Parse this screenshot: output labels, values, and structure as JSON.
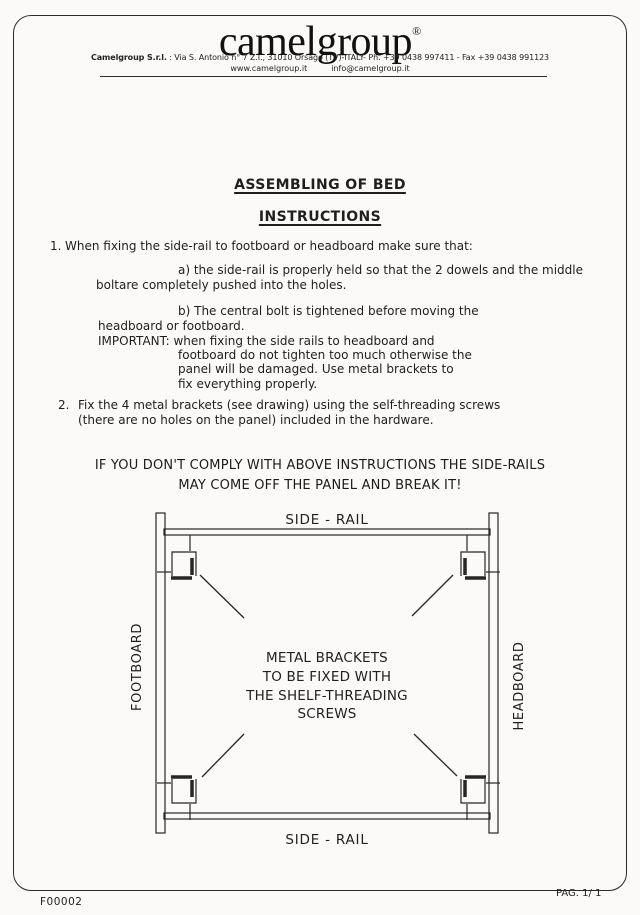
{
  "header": {
    "logo": "camelgroup",
    "registered_mark": "®",
    "company_name": "Camelgroup S.r.l.",
    "address": ": Via S. Antonio n° 7 Z.I., 31010 Orsago (TV)-ITALY- Ph. +39 0438 997411 - Fax +39 0438 991123",
    "website": "www.camelgroup.it",
    "email": "info@camelgroup.it"
  },
  "titles": {
    "main": "ASSEMBLING OF BED",
    "sub": "INSTRUCTIONS"
  },
  "instructions": {
    "item1": {
      "number": "1.",
      "text": "When fixing the side-rail to footboard or headboard make sure that:"
    },
    "item1a": [
      "a) the side-rail is properly held so that the 2 dowels and the middle",
      "boltare completely pushed into the holes."
    ],
    "item1b": [
      "b) The central bolt is tightened before moving the",
      "headboard or footboard.",
      "IMPORTANT: when fixing the side rails to headboard and",
      "footboard do not tighten too much otherwise the",
      "panel will be damaged.  Use metal brackets to",
      "fix everything properly."
    ],
    "item2": {
      "number": "2.",
      "lines": [
        "Fix the 4 metal brackets (see drawing) using the self-threading screws",
        "(there are no holes on the panel) included in the hardware."
      ]
    }
  },
  "warning": {
    "line1": "IF YOU DON'T COMPLY WITH ABOVE INSTRUCTIONS THE SIDE-RAILS",
    "line2": "MAY COME OFF THE PANEL AND BREAK IT!"
  },
  "diagram": {
    "side_rail_top": "SIDE - RAIL",
    "side_rail_bottom": "SIDE - RAIL",
    "footboard": "FOOTBOARD",
    "headboard": "HEADBOARD",
    "note": [
      "METAL BRACKETS",
      "TO BE FIXED WITH",
      "THE SHELF-THREADING",
      "SCREWS"
    ]
  },
  "footer": {
    "doc_code": "F00002",
    "page_label": "PAG. 1/ 1"
  },
  "colors": {
    "ink": "#1f1f1f",
    "paper": "#fbfaf8"
  }
}
